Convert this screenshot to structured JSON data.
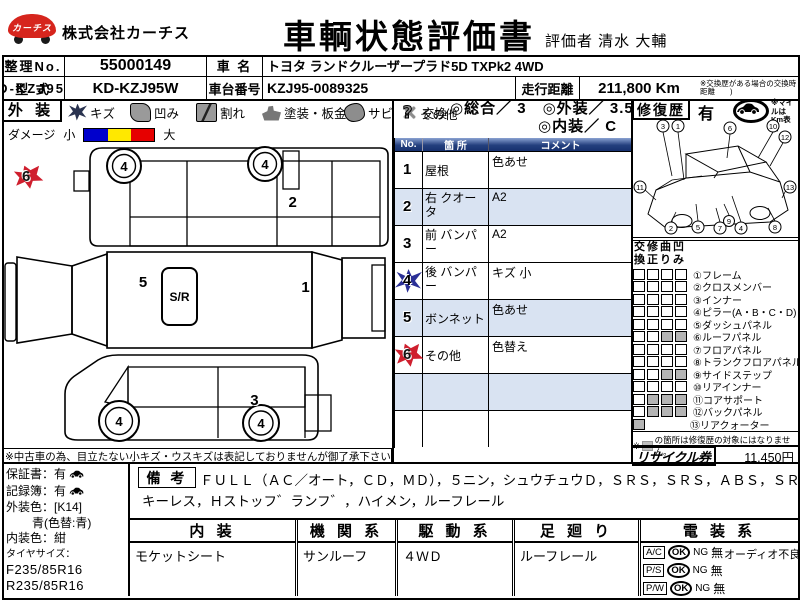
{
  "header": {
    "logo_text": "カーチス",
    "company": "株式会社カーチス",
    "title": "車輌状態評価書",
    "evaluator": "評価者 清水 大輔"
  },
  "info": {
    "seiri_label": "整理No.",
    "seiri_no": "55000149",
    "car_name_label": "車 名",
    "car_name": "トヨタ ランドクルーザープラド5D TXPk2  4WD",
    "katashiki_label": "型 式",
    "katashiki": "KD-KZJ95W",
    "chassis_label": "車台番号",
    "chassis_no": "KZJ95-0089325",
    "mileage_label": "走行距離",
    "mileage": "211,800 Km",
    "mileage_note": "※交換歴がある場合の交換時距離　　)"
  },
  "legend": {
    "section_label": "外 装",
    "items": [
      {
        "label": "キズ"
      },
      {
        "label": "凹み"
      },
      {
        "label": "割れ"
      },
      {
        "label": "塗装・板金"
      },
      {
        "label": "サビ"
      },
      {
        "label": "交換"
      },
      {
        "label": "その他"
      }
    ],
    "rating_line1": "◎総合／ 3　◎外装／ 3.5",
    "rating_line2": "◎内装／ C",
    "repair_label": "修復歴",
    "repair_value": "有",
    "mile_note": "※マイルはKm表示"
  },
  "damage": {
    "label": "ダメージ",
    "small": "小",
    "large": "大",
    "colors": [
      "#0000cc",
      "#ffe800",
      "#e60000"
    ]
  },
  "diagram": {
    "sunroof": "S/R",
    "wheel_no": "4",
    "note": "※中古車の為、目立たない小キズ・ウスキズは表記しておりませんが御了承下さい。",
    "markers": [
      {
        "no": "6",
        "icon": "rust"
      },
      {
        "no": "2",
        "icon": "question"
      },
      {
        "no": "5",
        "icon": "question"
      },
      {
        "no": "1",
        "icon": "question"
      },
      {
        "no": "4",
        "icon": "scratch"
      },
      {
        "no": "3",
        "icon": "question"
      }
    ]
  },
  "comments": {
    "h_no": "No.",
    "h_part": "箇 所",
    "h_comment": "コメント",
    "rows": [
      {
        "no": "1",
        "icon": "question",
        "part": "屋根",
        "comment": "色あせ"
      },
      {
        "no": "2",
        "icon": "question",
        "part": "右 クオータ",
        "comment": "A2"
      },
      {
        "no": "3",
        "icon": "question",
        "part": "前 バンパー",
        "comment": "A2"
      },
      {
        "no": "4",
        "icon": "scratch",
        "part": "後 バンパー",
        "comment": "キズ 小"
      },
      {
        "no": "5",
        "icon": "question",
        "part": "ボンネット",
        "comment": "色あせ"
      },
      {
        "no": "6",
        "icon": "rust",
        "part": "その他",
        "comment": "色替え"
      }
    ]
  },
  "wireframe": {
    "numbers": [
      "1",
      "2",
      "3",
      "4",
      "5",
      "6",
      "7",
      "8",
      "9",
      "10",
      "11",
      "12",
      "13"
    ]
  },
  "repair": {
    "cols": [
      "交換",
      "修正",
      "曲り",
      "凹み"
    ],
    "rows": [
      {
        "label": "①フレーム",
        "cells": [
          0,
          0,
          0,
          0
        ]
      },
      {
        "label": "②クロスメンバー",
        "cells": [
          0,
          0,
          0,
          0
        ]
      },
      {
        "label": "③インナー",
        "cells": [
          0,
          0,
          0,
          0
        ]
      },
      {
        "label": "④ピラー(A・B・C・D)",
        "cells": [
          0,
          0,
          0,
          0
        ]
      },
      {
        "label": "⑤ダッシュパネル",
        "cells": [
          0,
          0,
          0,
          0
        ]
      },
      {
        "label": "⑥ルーフパネル",
        "cells": [
          0,
          0,
          1,
          1
        ]
      },
      {
        "label": "⑦フロアパネル",
        "cells": [
          0,
          0,
          0,
          0
        ]
      },
      {
        "label": "⑧トランクフロアパネル",
        "cells": [
          0,
          0,
          0,
          0
        ]
      },
      {
        "label": "⑨サイドステップ",
        "cells": [
          0,
          0,
          1,
          1
        ]
      },
      {
        "label": "⑩リアインナー",
        "cells": [
          0,
          0,
          0,
          0
        ]
      },
      {
        "label": "⑪コアサポート",
        "cells": [
          0,
          1,
          1,
          1
        ]
      },
      {
        "label": "⑫バックパネル",
        "cells": [
          0,
          1,
          1,
          1
        ]
      },
      {
        "label": "⑬リアクォーター",
        "cells": [
          1
        ]
      }
    ],
    "note_mark": "※",
    "note": "の箇所は修復歴の対象にはなりません。",
    "recycle_label": "リサイクル券",
    "recycle_value": "11,450円"
  },
  "vehicle": {
    "warranty": "保証書：有",
    "record": "記録簿：有",
    "ext_color": "外装色：[K14]",
    "ext_color2": "青(色替:青)",
    "int_color": "内装色：紺",
    "tire_label": "タイヤサイズ：",
    "tire_f": "F235/85R16",
    "tire_r": "R235/85R16"
  },
  "remarks": {
    "label": "備 考",
    "line1": "ＦＵＬＬ（ＡＣ／オート，ＣＤ，ＭＤ），５ニン，シュウチュウＤ，ＳＲＳ，ＳＲＳ，ＡＢＳ，ＳＲ，",
    "line2": "キーレス，Ｈストッフ゛ランフ゛，ハイメン，ルーフレール"
  },
  "bottom": {
    "cols": [
      {
        "h": "内 装",
        "v": "モケットシート"
      },
      {
        "h": "機 関 系",
        "v": "サンルーフ"
      },
      {
        "h": "駆 動 系",
        "v": "４ＷＤ"
      },
      {
        "h": "足 廻 り",
        "v": "ルーフレール"
      }
    ],
    "elec": {
      "h": "電 装 系",
      "note": "オーディオ不良",
      "rows": [
        {
          "l": "A/C",
          "ok": "OK",
          "ng": "NG",
          "no": "無"
        },
        {
          "l": "P/S",
          "ok": "OK",
          "ng": "NG",
          "no": "無"
        },
        {
          "l": "P/W",
          "ok": "OK",
          "ng": "NG",
          "no": "無"
        }
      ]
    }
  }
}
